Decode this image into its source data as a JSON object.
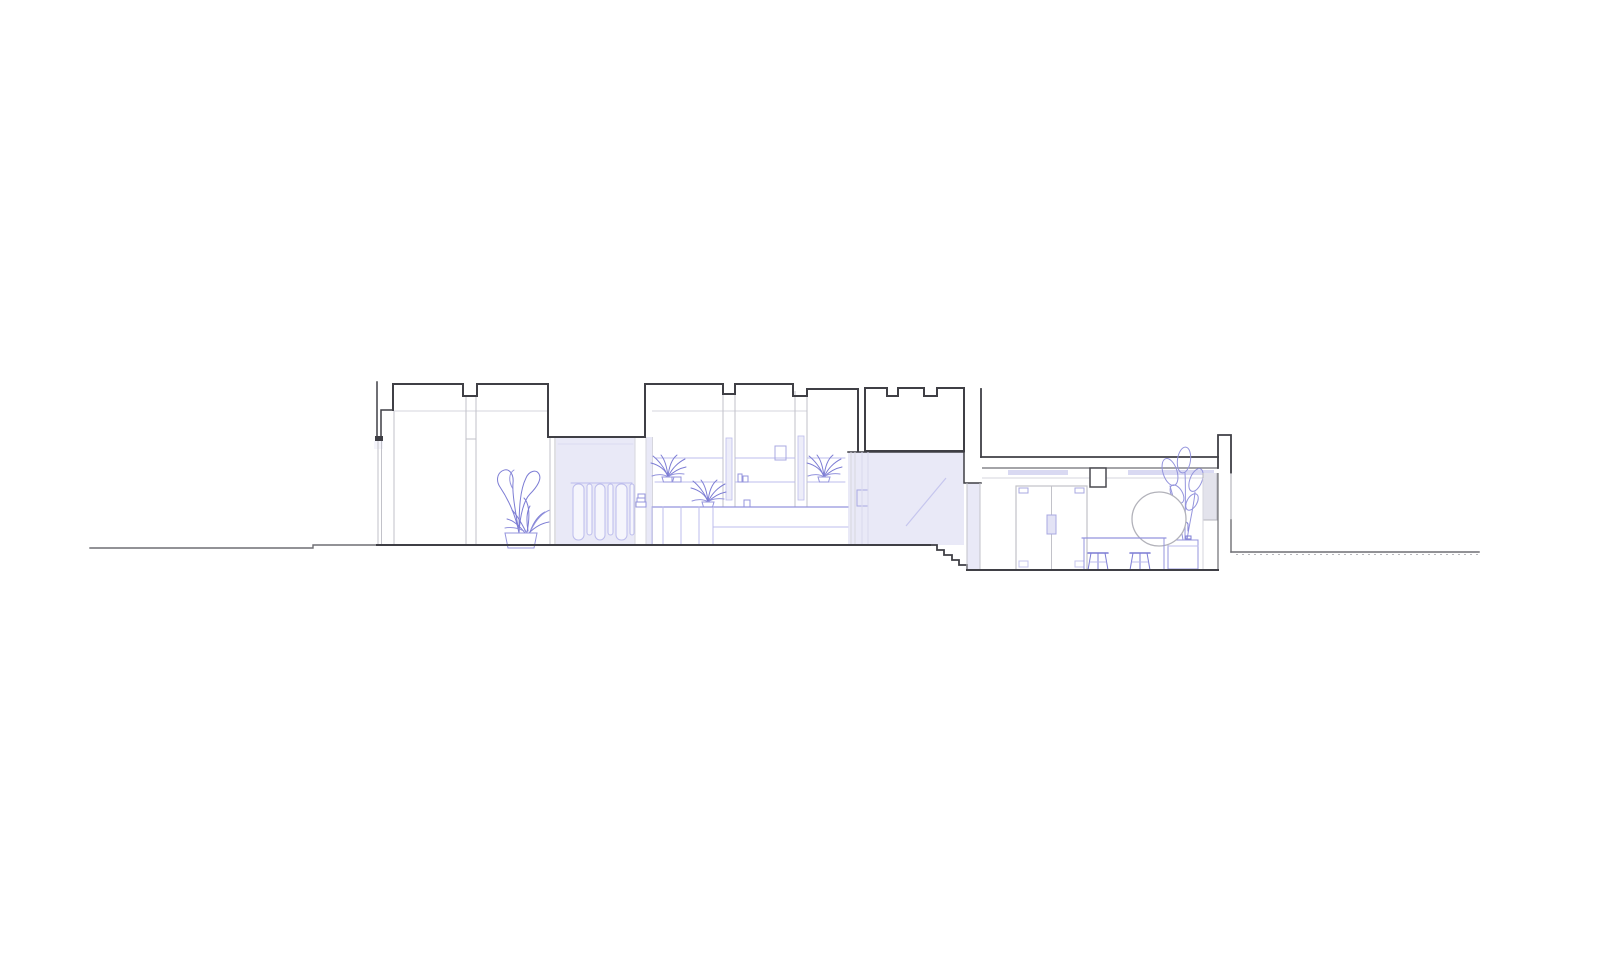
{
  "scene": {
    "label": "Architectural cross-section drawing of a single-storey building with sunken rear room",
    "type": "architectural-section",
    "style": "thin dark section lines, light grey elevation lines, lavender glazing fills, purple furnishings and plants",
    "features": [
      "left ground line with small step",
      "left wing with stepped parapet roof and roof notches",
      "boundary wall stub at left facade",
      "tall potted plant in left room",
      "glazed corridor with slatted screen door (sectioned, lavender)",
      "middle room with wall shelving, spider plants, picture frames, base cabinets and bench",
      "castellated rooflight box",
      "glazed partition with diagonal glazing mark (sectioned, lavender)",
      "stair of five steps down to lower room",
      "lower room with double door, round mirror, counter with two stools and tall plant",
      "window in right perimeter wall",
      "right ground line with hatched texture"
    ]
  },
  "palette": {
    "canvas-bg": "#ffffff",
    "line-dark": "#3f3f45",
    "line-mid": "#6e6e73",
    "line-gray": "#c2c2c9",
    "line-gray-soft": "#d6d6de",
    "line-purple": "#9494dd",
    "line-purple-strong": "#7c7cd4",
    "line-purple-soft": "#bcbcec",
    "fill-lavender": "#e9e9f7",
    "fill-lavender-soft": "#f5f5fc",
    "fill-window": "#e3e3ec",
    "fixture-lavender": "#d9d9f2"
  }
}
